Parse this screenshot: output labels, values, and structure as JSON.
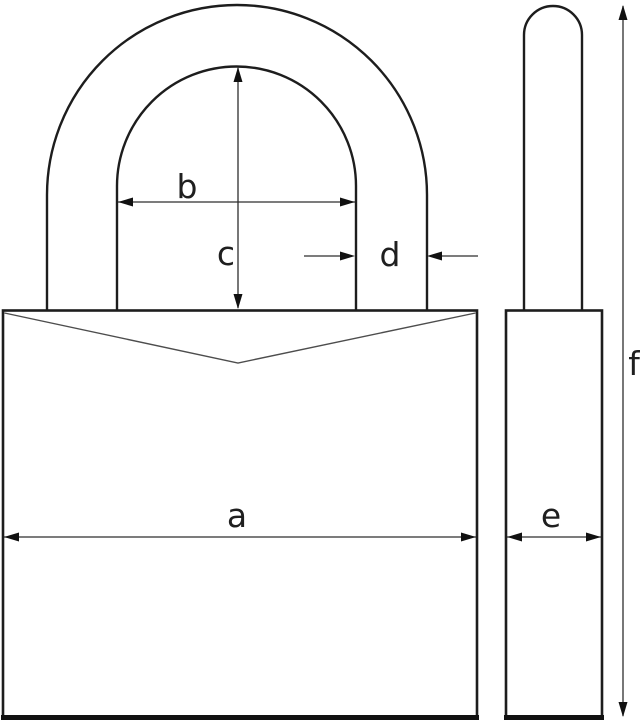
{
  "diagram": {
    "type": "technical-dimension-drawing",
    "subject": "padlock front view and side profile with dimension arrows",
    "labels": {
      "a": "a",
      "b": "b",
      "c": "c",
      "d": "d",
      "e": "e",
      "f": "f"
    },
    "colors": {
      "background": "#ffffff",
      "outline": "#1d1d1d",
      "dimension_line": "#2e2e2e",
      "chevron_line": "#4d4d4d"
    }
  }
}
